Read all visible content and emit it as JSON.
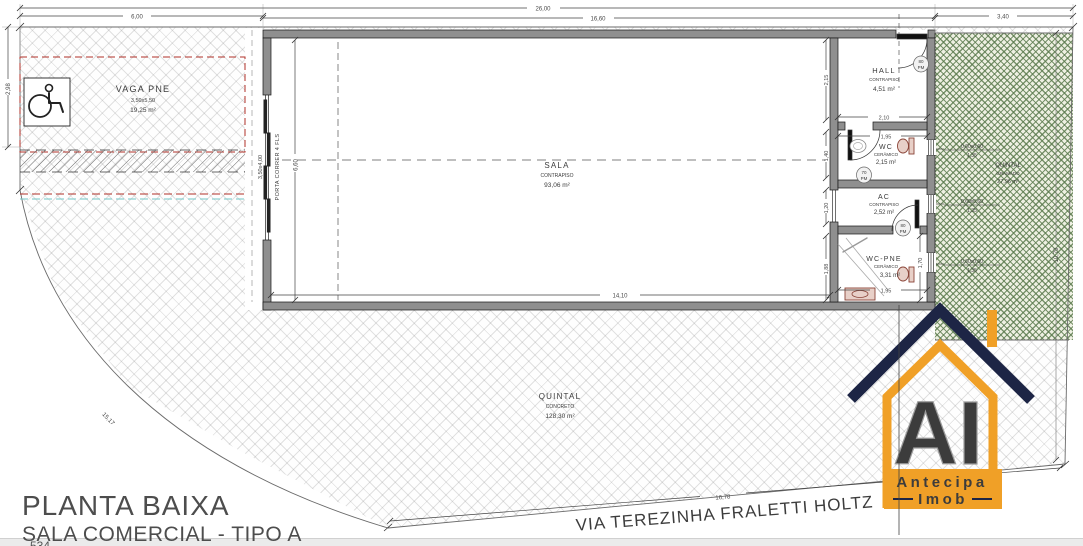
{
  "plan": {
    "title": "PLANTA BAIXA",
    "subtitle": "SALA COMERCIAL - TIPO A",
    "footer_partial": "534",
    "street_name": "VIA TEREZINHA FRALETTI HOLTZ"
  },
  "rooms": {
    "vaga_pne": {
      "name": "VAGA PNE",
      "size": "3,50x5,50",
      "area": "19,25 m²"
    },
    "sala": {
      "name": "SALA",
      "finish": "CONTRAPISO",
      "area": "93,06 m²"
    },
    "hall": {
      "name": "HALL",
      "finish": "CONTRAPISO",
      "area": "4,51 m²"
    },
    "wc": {
      "name": "WC",
      "finish": "CERÂMICO",
      "area": "2,15 m²"
    },
    "ac": {
      "name": "AC",
      "finish": "CONTRAPISO",
      "area": "2,52 m²"
    },
    "wc_pne": {
      "name": "WC-PNE",
      "finish": "CERÂMICO",
      "area": "3,31 m²"
    },
    "quintal": {
      "name": "QUINTAL",
      "finish": "CONCRETO",
      "area": "128,30 m²"
    },
    "quintal_gramado": {
      "name": "QUINTAL",
      "finish": "GRAMADO",
      "area": "27,96 m²"
    }
  },
  "doors": {
    "entry": {
      "width": "80",
      "type": "PM"
    },
    "wc": {
      "width": "70",
      "type": "PM"
    },
    "wc_pne": {
      "width": "80",
      "type": "PM"
    },
    "sliding": {
      "label": "PORTA CORRER 4 FLS",
      "size": "3,50x4,00"
    }
  },
  "window_label": {
    "spec": "0,60x0,60",
    "sill": "1,35"
  },
  "dimensions": {
    "total_width": "26,00",
    "vaga_width": "6,00",
    "building_width": "16,60",
    "garden_width": "3,40",
    "vaga_height": "2,98",
    "sala_width": "14,10",
    "sala_height": "6,60",
    "hall_height": "2,15",
    "hall_width": "2,10",
    "wc_width": "1,95",
    "wc_height": "1,40",
    "ac_height": "1,20",
    "wc_pne_height": "1,88",
    "wc_pne_inner": "1,70",
    "wc_pne_width": "1,95",
    "lot_right_height": "10,79",
    "lot_arc": "15,17",
    "street_length": "16,78"
  },
  "logo": {
    "monogram": "AI",
    "name_line1": "Antecipa",
    "name_line2": "Imob"
  },
  "colors": {
    "orange": "#F0A027",
    "navy": "#1D2545",
    "wall": "#8F8F8F",
    "vaga_red": "#B03028",
    "green": "#5A7A4D"
  }
}
